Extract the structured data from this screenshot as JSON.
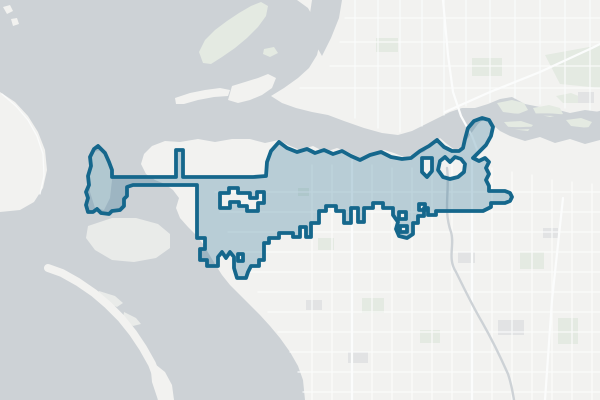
{
  "map": {
    "description": "city-boundary-overlay-map",
    "colors": {
      "water": "#cdd2d6",
      "land": "#f2f2f0",
      "land_flat": "#e9ebe9",
      "green_area": "#e4eae2",
      "built_area": "#e2e3e4",
      "road": "#fbfcfc",
      "boundary_stroke": "#15678c",
      "boundary_fill": "rgba(21,102,139,0.26)"
    },
    "boundary_stroke_width": 3.8,
    "layers": [
      {
        "id": "water-bg",
        "fill": "water",
        "paths": [
          {
            "name": "bay-water",
            "d": "M0,0H600V400H0Z"
          }
        ]
      },
      {
        "id": "land",
        "fill": "land",
        "paths": [
          {
            "name": "south-mainland",
            "d": "M279,140 L265,143 250,139 232,139 215,142 198,139 180,142 165,141 152,146 144,154 141,164 146,174 155,180 165,184 173,190 179,198 176,208 180,218 188,227 196,235 203,244 209,254 215,264 222,275 230,285 240,295 250,305 260,315 270,326 280,338 290,352 298,366 303,380 305,400 L600,400 600,140 L585,144 570,139 555,143 540,137 525,141 510,136 500,131 492,124 485,118 478,124 470,135 462,147 455,150 447,144 440,138 432,144 424,152 414,155 404,157 394,153 384,150 372,154 360,158 348,152 337,148 325,152 313,146 300,150 288,145 Z"
          },
          {
            "name": "north-mainland",
            "d": "M297,0 L600,0 600,112 L585,110 570,113 555,109 540,107 525,104 512,97 500,99 488,104 475,108 462,108 450,112 438,118 426,124 412,131 398,135 382,133 364,128 344,121 328,115 312,112 296,108 282,103 271,96 L284,88 298,78 309,68 317,55 320,42 317,24 308,8 Z"
          },
          {
            "name": "west-shore",
            "d": "M0,92 L15,102 28,116 38,132 45,150 47,170 43,188 34,202 20,210 0,212 Z"
          },
          {
            "name": "peninsula",
            "d": "M232,86 L245,82 258,78 268,74 276,78 272,88 262,95 250,100 238,103 228,100 Z"
          },
          {
            "name": "sand-spit-north",
            "d": "M175,98 L190,93 205,90 220,88 230,90 228,96 214,97 198,100 184,104 176,104 Z"
          },
          {
            "name": "spit-base",
            "d": "M150,360 L165,372 172,385 174,400 158,400 152,382 Z"
          },
          {
            "name": "islet-nw-1",
            "d": "M3,7 L10,5 13,11 7,14 Z"
          },
          {
            "name": "islet-nw-2",
            "d": "M11,19 L17,18 19,24 13,26 Z"
          }
        ]
      },
      {
        "id": "water-cutouts",
        "fill": "water",
        "paths": [
          {
            "name": "slough-arm",
            "d": "M312,0 L342,0 339,18 331,38 322,56 314,42 309,20 Z"
          }
        ]
      },
      {
        "id": "flats",
        "fill": "land_flat",
        "paths": [
          {
            "name": "tidal-flats",
            "d": "M88,226 L112,218 136,218 158,224 170,234 170,248 156,258 134,262 112,260 95,250 86,238 Z"
          },
          {
            "name": "jetty-island",
            "d": "M93,152 L104,150 110,162 112,180 110,198 104,210 95,208 90,192 90,172 Z"
          },
          {
            "name": "lagoon-islet-1",
            "d": "M99,291 L115,296 123,303 117,307 103,301 96,295 Z"
          },
          {
            "name": "lagoon-islet-2",
            "d": "M124,312 L136,318 141,324 133,326 123,319 Z"
          }
        ]
      },
      {
        "id": "spit-stroke",
        "stroke": "land",
        "stroke_width": 8,
        "fill": "none",
        "paths": [
          {
            "name": "barrier-spit",
            "d": "M48,268 L62,273 78,282 94,293 108,305 121,318 133,333 143,348 152,364 158,380 161,395 162,400"
          }
        ]
      },
      {
        "id": "green",
        "fill": "green_area",
        "paths": [
          {
            "name": "island-green",
            "d": "M203,63 L199,52 205,40 215,30 227,21 239,13 251,6 261,2 268,6 266,16 258,27 247,38 235,48 222,57 211,64 Z"
          },
          {
            "name": "islet-channel",
            "d": "M264,49 L274,47 278,53 270,57 263,54 Z"
          },
          {
            "name": "delta-islet-1",
            "d": "M497,103 L512,100 524,103 528,110 518,114 503,112 Z"
          },
          {
            "name": "delta-islet-2",
            "d": "M533,108 L549,105 560,108 563,114 550,117 536,114 Z"
          },
          {
            "name": "delta-islet-3",
            "d": "M556,96 L571,93 581,97 578,103 563,103 Z"
          },
          {
            "name": "delta-islet-4",
            "d": "M504,122 L521,121 533,125 528,131 510,129 Z"
          },
          {
            "name": "delta-islet-5",
            "d": "M566,120 L581,118 592,122 588,128 571,126 Z"
          },
          {
            "name": "forest-ne",
            "d": "M545,55 L600,45 600,88 560,84 Z"
          },
          {
            "name": "park-1",
            "d": "M318,238h16v12h-16z"
          },
          {
            "name": "park-2",
            "d": "M362,298h22v15h-22z"
          },
          {
            "name": "park-3",
            "d": "M420,330h20v13h-20z"
          },
          {
            "name": "park-4",
            "d": "M520,252h24v17h-24z"
          },
          {
            "name": "park-5",
            "d": "M558,318h20v26h-20z"
          },
          {
            "name": "park-6",
            "d": "M472,58h30v18h-30z"
          },
          {
            "name": "park-7",
            "d": "M376,38h22v14h-22z"
          },
          {
            "name": "park-8",
            "d": "M298,188h11v8h-11z"
          }
        ]
      },
      {
        "id": "built",
        "fill": "built_area",
        "paths": [
          {
            "name": "built-1",
            "d": "M306,300h16v10h-16z"
          },
          {
            "name": "built-2",
            "d": "M348,352h20v11h-20z"
          },
          {
            "name": "built-3",
            "d": "M498,320h26v15h-26z"
          },
          {
            "name": "built-4",
            "d": "M458,252h17v11h-17z"
          },
          {
            "name": "built-5",
            "d": "M543,228h15v10h-15z"
          },
          {
            "name": "built-6",
            "d": "M578,92h16v11h-16z"
          }
        ]
      },
      {
        "id": "roads-minor",
        "stroke": "road",
        "stroke_width": 1.3,
        "fill": "none",
        "opacity": 0.9,
        "paths": [
          {
            "name": "street-grid-v",
            "d": "M312,165V400 M332,165V400 M372,165V400 M392,168V400 M412,168V400 M432,165V400 M452,162V400 M492,168V400 M512,172V400 M532,175V400 M552,180V400 M572,182V400 M592,184V400"
          },
          {
            "name": "street-grid-h",
            "d": "M215,192H600 M220,212H600 M228,232H600 M240,252H600 M248,272H600 M258,292H600 M268,312H600 M278,332H600 M290,352H600 M298,372H600 M303,392H600"
          },
          {
            "name": "street-grid-north",
            "d": "M355,0V118 M378,0V128 M400,0V132 M422,0V126 M444,0V115 M466,0V106 M490,0V102 M515,0V98 M540,0V104 M565,0V108 M590,0V110 M345,18H600 M340,42H600 M330,66H600 M300,88H600"
          },
          {
            "name": "shore-road-west",
            "d": "M2,94 L16,106 28,120 37,136 43,154 44,176 40,194"
          }
        ]
      },
      {
        "id": "roads-major",
        "stroke": "road",
        "stroke_width": 2.2,
        "fill": "none",
        "paths": [
          {
            "name": "highway-ne-diagonal",
            "d": "M445,112 L490,92 540,72 592,48 600,44"
          },
          {
            "name": "highway-trestle",
            "d": "M443,0 L448,55 453,92 461,116 472,136 478,152"
          },
          {
            "name": "highway-east",
            "d": "M563,198 L552,300 545,400"
          },
          {
            "name": "avenue-central",
            "d": "M352,160V400"
          },
          {
            "name": "avenue-east",
            "d": "M472,160V400"
          }
        ]
      },
      {
        "id": "waterways",
        "stroke": "water",
        "stroke_width": 2.4,
        "fill": "none",
        "paths": [
          {
            "name": "creek-se",
            "d": "M447,168 C450,190 443,210 451,232 C455,245 447,258 456,272 C464,288 472,305 482,322 C490,336 500,356 508,374 C512,386 513,394 514,400"
          },
          {
            "name": "river-strand-1",
            "d": "M485,112 C510,118 540,112 565,116 C580,118 592,114 600,112"
          },
          {
            "name": "river-strand-2",
            "d": "M495,126 C520,132 548,124 575,128 C588,130 596,127 600,126"
          }
        ]
      },
      {
        "id": "boundary",
        "fill": "boundary_fill",
        "stroke": "boundary_stroke",
        "stroke_width": 3.8,
        "fill_rule": "evenodd",
        "paths": [
          {
            "name": "city-boundary-polygon",
            "interactable": true,
            "d": "M98,146 L105,153 109,162 112,170 112,177 L176,177 176,150 183,150 183,177 L253,177 266,176 267,162 271,151 279,142 L287,148 297,152 307,149 315,153 324,150 333,154 342,151 351,156 360,160 370,155 381,152 391,157 402,159 411,158 420,151 429,146 437,140 L444,147 452,151 459,151 463,148 L465,139 468,128 474,121 482,118 489,120 493,127 491,136 486,145 479,152 473,158 L479,161 485,158 489,162 L486,168 489,174 486,180 489,186 489,191 L505,191 510,193 512,197 510,201 505,203 491,203 491,207 487,209 483,211 L436,211 436,215 428,215 428,208 424,208 424,216 418,216 418,223 413,223 413,234 407,238 399,236 396,229 398,222 393,215 393,208 383,208 383,203 373,203 373,208 364,208 364,222 358,222 358,208 351,208 351,223 344,223 344,211 336,211 336,206 326,206 326,211 319,211 319,223 311,223 311,237 306,237 306,227 300,227 300,237 293,237 293,233 279,233 279,238 269,238 269,243 264,243 264,260 259,260 259,266 251,266 248,272 246,278 237,278 234,268 234,257 230,252 226,258 222,252 218,257 218,266 207,266 207,260 200,260 200,249 205,249 205,238 197,238 197,185 L133,185 127,187 127,196 124,199 124,206 120,210 112,211 109,214 101,213 97,209 93,212 88,212 86,205 88,198 86,192 89,185 88,176 91,166 90,157 94,149 Z M220,193 L229,193 229,188 238,188 238,193 250,193 250,198 257,198 257,192 264,192 264,203 258,203 258,211 247,211 247,206 239,206 239,202 230,202 230,208 220,208 Z M440,161 L445,157 450,162 455,157 461,159 465,164 464,172 458,177 450,179 443,177 438,170 Z M422,158 L432,158 432,171 427,177 422,172 Z M399,212 L406,212 406,219 399,219 Z M400,226 L407,226 407,232 400,232 Z M419,204 L425,204 425,210 419,210 Z M238,254 L243,254 243,261 238,261 Z"
          }
        ]
      }
    ]
  }
}
